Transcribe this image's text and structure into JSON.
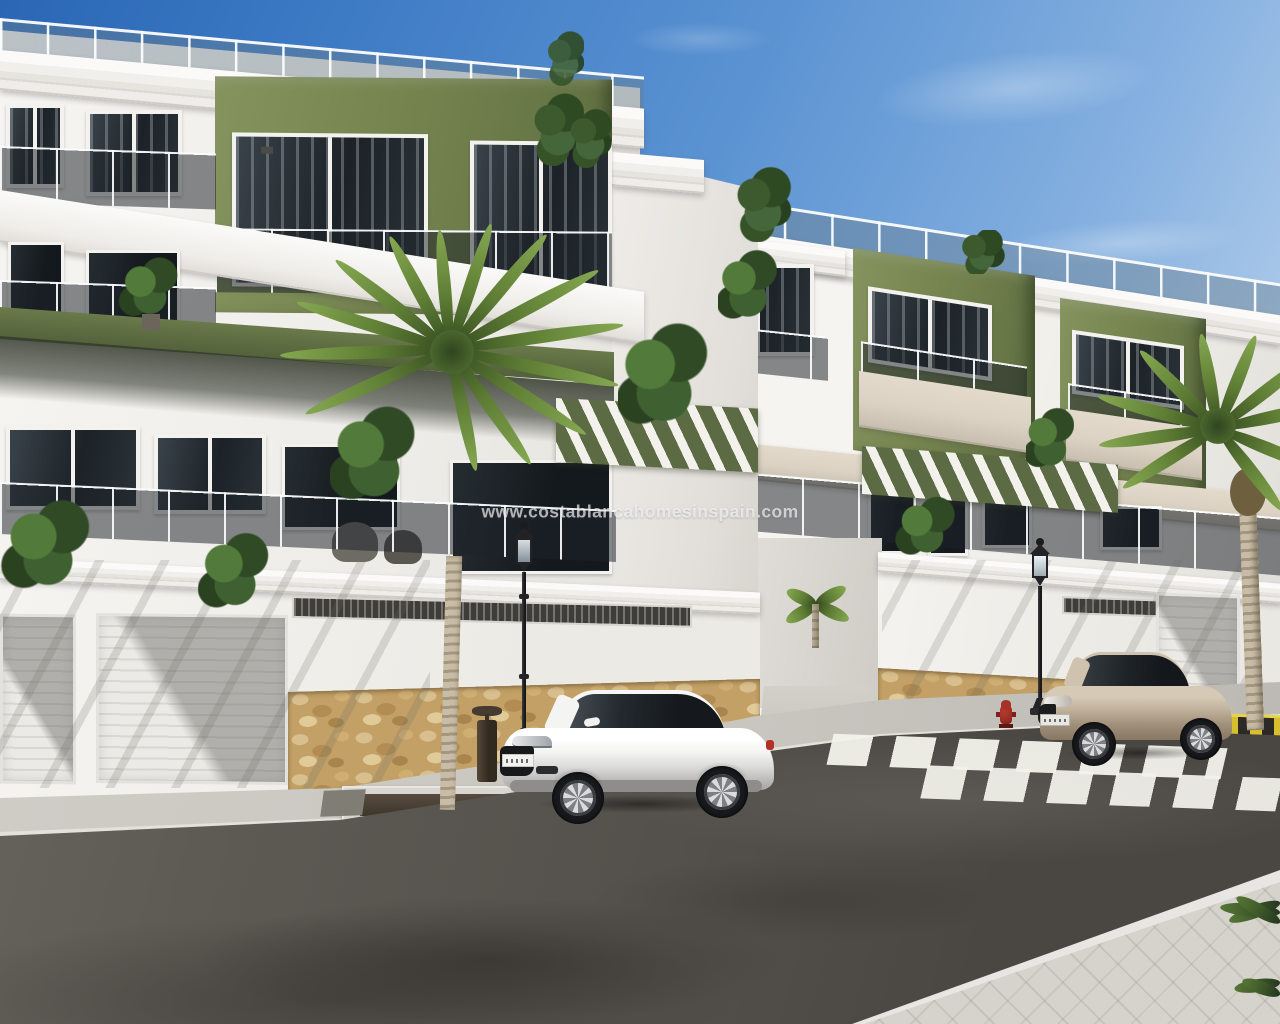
{
  "watermark": {
    "text": "www.costablancahomesinspain.com"
  },
  "palette": {
    "sky_top": "#2a66b4",
    "sky_mid": "#5b93d2",
    "sky_horizon": "#d8e6f5",
    "wall_white": "#f6f4f0",
    "wall_shade": "#e2dfda",
    "facade_green": "#75844f",
    "facade_green_dark": "#5c6a3f",
    "slab_beige": "#dbd2c4",
    "pergola_olive": "#5d6b44",
    "glass_dark": "#1c2227",
    "window_frame": "#f3f2ef",
    "stone_tan": "#c2a066",
    "road_asphalt": "#55514c",
    "sidewalk_gray": "#c9c6c0",
    "pavement_light": "#d6d3cd",
    "crosswalk_white": "#f3f2eb",
    "hazard_yellow": "#d8bf2e",
    "hazard_black": "#2c2a26",
    "lamp_black": "#232327",
    "hydrant_red": "#9c2d24",
    "car_white": "#f3f3f2",
    "car_beige": "#bfb09a",
    "palm_green": "#5f7e35",
    "palm_trunk": "#b4a78f"
  }
}
